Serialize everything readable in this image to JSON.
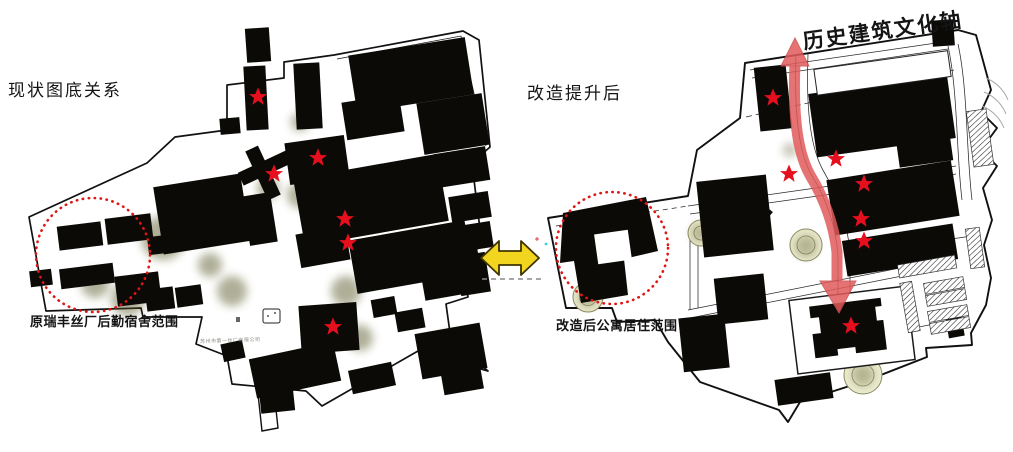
{
  "figure": {
    "left_panel": {
      "title": "现状图底关系",
      "caption": "原瑞丰丝厂后勤宿舍范围",
      "tiny_label": "苏州市第一丝厂有限公司",
      "stars": [
        [
          258,
          97
        ],
        [
          318,
          158
        ],
        [
          274,
          174
        ],
        [
          345,
          219
        ],
        [
          348,
          243
        ],
        [
          333,
          327
        ]
      ],
      "highlight_circle": {
        "cx": 93,
        "cy": 255,
        "r": 57
      }
    },
    "right_panel": {
      "title": "改造提升后",
      "axis_label": "历史建筑文化轴",
      "caption": "改造后公寓居住范围",
      "stars": [
        [
          773,
          98
        ],
        [
          836,
          159
        ],
        [
          789,
          174
        ],
        [
          864,
          184
        ],
        [
          861,
          219
        ],
        [
          864,
          241
        ],
        [
          851,
          326
        ]
      ],
      "highlight_circle": {
        "cx": 612,
        "cy": 248,
        "r": 56
      }
    },
    "colors": {
      "star": "#e60f1e",
      "highlight_circle": "#e01616",
      "axis_arrow": "#e25b5b",
      "swap_arrow_fill": "#f2d51e",
      "swap_arrow_stroke": "#3f3400",
      "building": "#0b0a07"
    }
  }
}
